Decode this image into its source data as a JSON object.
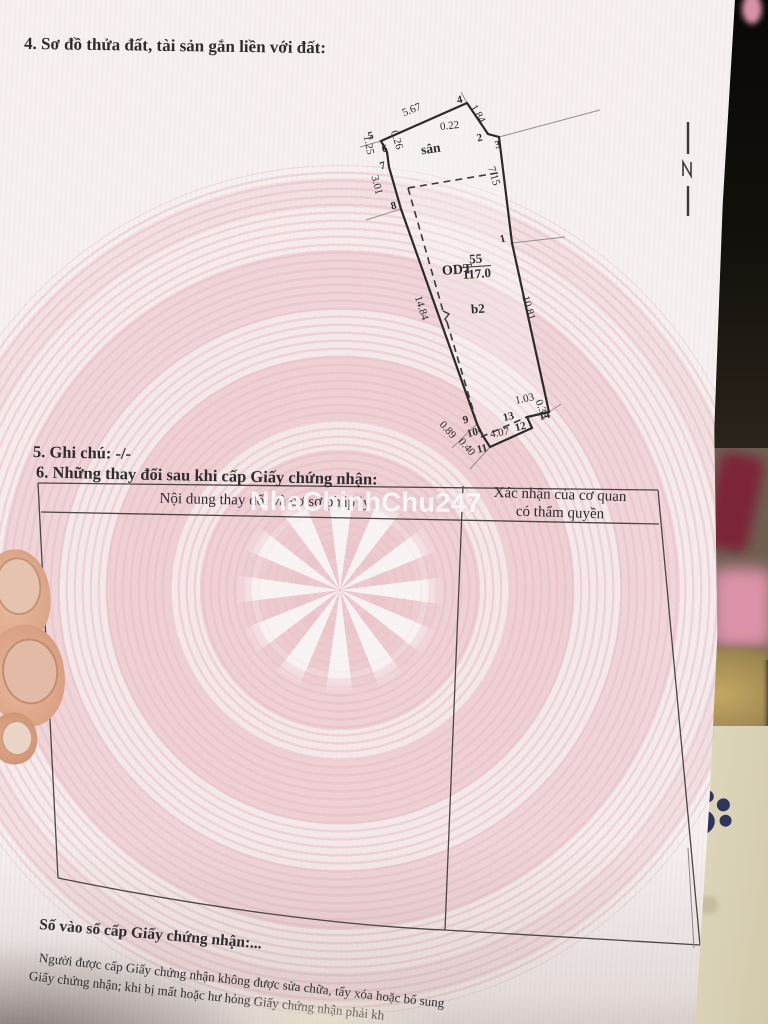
{
  "document": {
    "section4_title": "4. Sơ đồ thửa đất, tài sản gắn liền với đất:",
    "section5_note": "5. Ghi chú: -/-",
    "section6_title": "6. Những thay đổi sau khi cấp Giấy chứng nhận:",
    "table": {
      "col1_header": "Nội dung thay đổi và cơ sở pháp lý",
      "col2_header_line1": "Xác nhận của cơ quan",
      "col2_header_line2": "có thẩm quyền"
    },
    "footer": {
      "register_line": "Số vào sổ cấp Giấy chứng nhận:...",
      "note_line1": "Người được cấp Giấy chứng nhận không được sửa chữa, tẩy xóa hoặc bổ sung",
      "note_line2": "Giấy chứng nhận; khi bị mất hoặc hư hỏng Giấy chứng nhận phải kh"
    },
    "watermark": "NhaChinhChu247"
  },
  "diagram": {
    "parcel": {
      "land_use_code": "ODT",
      "parcel_number": "55",
      "area_m2": "117.0"
    },
    "labels": {
      "yard": "sân",
      "building": "b2"
    },
    "points": [
      "1",
      "2",
      "3",
      "4",
      "5",
      "6",
      "7",
      "8",
      "9",
      "10",
      "11",
      "12",
      "13",
      "14"
    ],
    "dimensions": [
      "5.67",
      "1.84",
      "0.22",
      "0.26",
      "1.25",
      "3.01",
      "7.15",
      "14.84",
      "10.81",
      "1.03",
      "0.39",
      "4.07",
      "0.40",
      "0.89"
    ]
  },
  "colors": {
    "paper": "#f6f0f0",
    "pattern_pink": "#eecdd2",
    "ink": "#2e2c2e",
    "watermark_text": "#fdfcfd"
  }
}
